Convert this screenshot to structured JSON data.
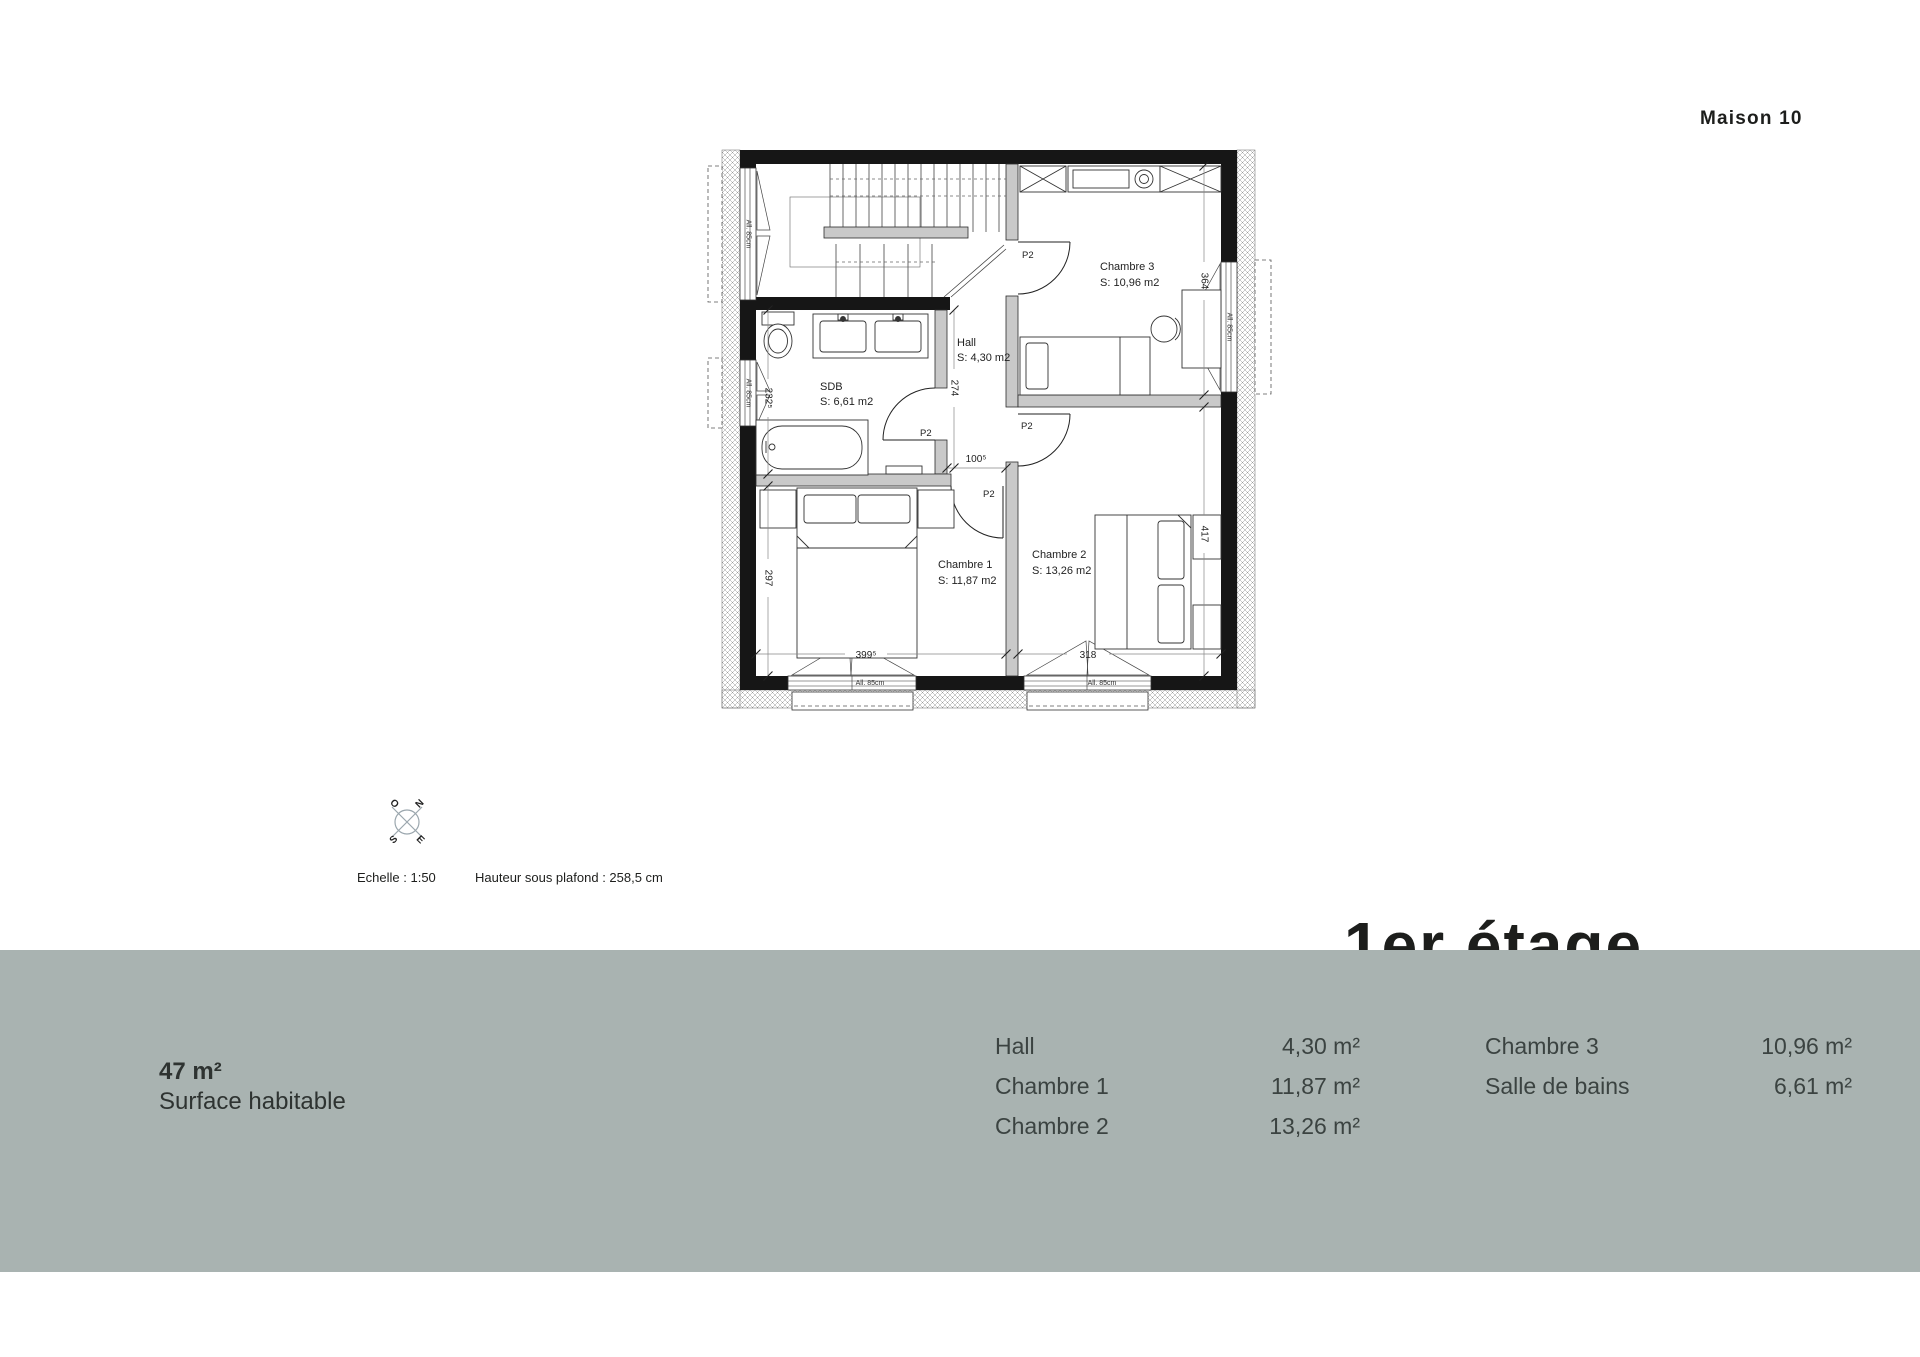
{
  "header": {
    "project": "Maison 10"
  },
  "floor_label": "1er étage",
  "meta": {
    "scale": "Echelle : 1:50",
    "ceiling": "Hauteur sous plafond : 258,5 cm"
  },
  "compass": {
    "n": "N",
    "o": "O",
    "e": "E",
    "s": "S"
  },
  "plan": {
    "door_label": "P2",
    "window_label": "All. 85cm",
    "rooms": {
      "hall": {
        "name": "Hall",
        "area": "S: 4,30 m2"
      },
      "sdb": {
        "name": "SDB",
        "area": "S: 6,61 m2"
      },
      "ch1": {
        "name": "Chambre 1",
        "area": "S: 11,87 m2"
      },
      "ch2": {
        "name": "Chambre 2",
        "area": "S: 13,26 m2"
      },
      "ch3": {
        "name": "Chambre 3",
        "area": "S: 10,96 m2"
      }
    },
    "dims": {
      "ch3_height": "364",
      "ch2_height": "417",
      "ch1_height": "297",
      "sdb_height": "232⁵",
      "hall_height": "274",
      "hall_width": "100⁵",
      "ch1_width": "399⁵",
      "ch2_width": "318"
    }
  },
  "banner": {
    "surface_value": "47 m²",
    "surface_label": "Surface habitable",
    "columns": [
      {
        "rows": [
          {
            "label": "Hall",
            "value": "4,30 m²"
          },
          {
            "label": "Chambre 1",
            "value": "11,87 m²"
          },
          {
            "label": "Chambre 2",
            "value": "13,26 m²"
          }
        ]
      },
      {
        "rows": [
          {
            "label": "Chambre 3",
            "value": "10,96 m²"
          },
          {
            "label": "Salle de bains",
            "value": "6,61 m²"
          }
        ]
      }
    ]
  },
  "colors": {
    "banner_bg": "#a9b3b1",
    "wall_black": "#161616",
    "partition_gray": "#c9c9c9",
    "text_dark": "#1d1e1c",
    "banner_text": "#3b4341"
  }
}
